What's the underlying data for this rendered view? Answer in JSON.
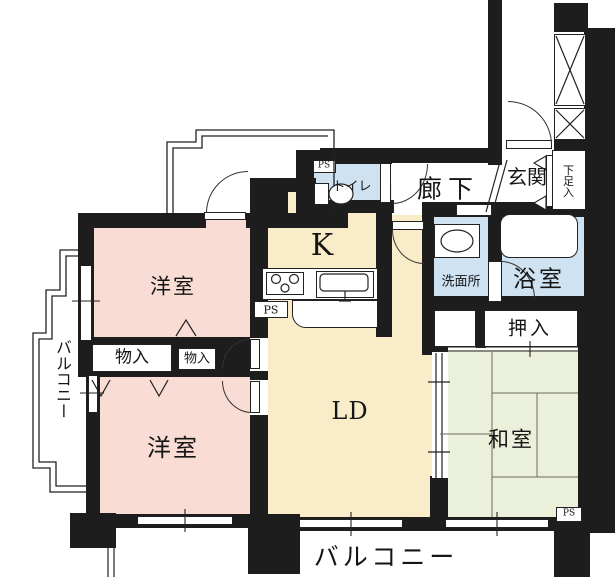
{
  "colors": {
    "bg": "#ffffff",
    "wall": "#1d1d1d",
    "room_pink": "#f9ddd5",
    "room_cream": "#f9edc9",
    "room_blue": "#cfe2f1",
    "room_green": "#eaf0d9"
  },
  "rooms": {
    "western_room_upper": "洋室",
    "western_room_lower": "洋室",
    "living_dining": "LD",
    "kitchen": "K",
    "japanese_room": "和室",
    "hallway": "廊下",
    "entrance": "玄関",
    "toilet": "トイレ",
    "washroom": "洗面所",
    "bathroom": "浴室",
    "balcony_left": "バルコニー",
    "balcony_bottom": "バルコニー"
  },
  "storage": {
    "closet_1": "物入",
    "closet_2": "物入",
    "oshiire": "押入",
    "shoe_cabinet": "下足入"
  },
  "utility": {
    "ps_top": "PS",
    "ps_kitchen": "PS",
    "ps_bottom_right": "PS"
  }
}
